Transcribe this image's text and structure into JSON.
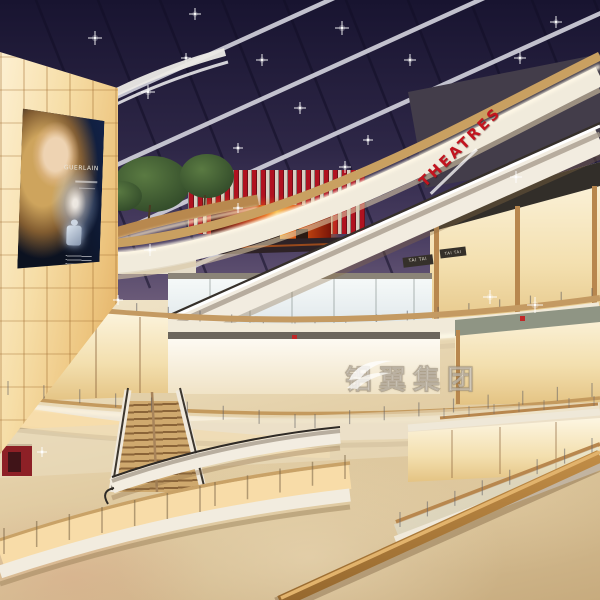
{
  "scene": {
    "description": "Multi-level shopping mall atrium interior at evening, architectural rendering",
    "levels": 5
  },
  "signs": {
    "theatre": "THEATRES",
    "store_tag_1": "TAI TAI",
    "store_tag_2": "TAI TAI",
    "billboard_brand": "GUERLAIN"
  },
  "watermark": {
    "text": "铝翼集团"
  },
  "colors": {
    "sky_top": "#181430",
    "sky_bottom": "#6a5a78",
    "beam": "#d4d4de",
    "theatre_red": "#c3141f",
    "fin_red": "#b5121d",
    "fascia_cream": "#f1ebdc",
    "fascia_wood": "#c9a061",
    "glow_warm": "#f8dca8",
    "floor_light": "#f2e9d4",
    "floor_dark": "#c7ab7e",
    "screen_fire": "#e86a1a",
    "wood_rail": "#b07c3e",
    "wall_glow": "#f6dda6"
  },
  "people": [
    [
      310,
      283,
      11,
      "#d9604a"
    ],
    [
      322,
      282,
      11,
      "#4a6fa8"
    ],
    [
      335,
      284,
      11,
      "#e8e4da"
    ],
    [
      414,
      287,
      11,
      "#8a8a92"
    ],
    [
      472,
      244,
      12,
      "#d8d2c4"
    ],
    [
      487,
      242,
      12,
      "#6a88aa"
    ],
    [
      503,
      244,
      12,
      "#b55248"
    ],
    [
      212,
      245,
      11,
      "#9a9aa2"
    ],
    [
      223,
      246,
      11,
      "#b23a3a"
    ],
    [
      34,
      362,
      14,
      "#c8c4ba"
    ],
    [
      76,
      372,
      13,
      "#5577aa"
    ],
    [
      87,
      373,
      13,
      "#e2ded4"
    ],
    [
      230,
      418,
      13,
      "#c46a78"
    ],
    [
      38,
      452,
      15,
      "#4a78b8"
    ],
    [
      50,
      454,
      15,
      "#88a8cc"
    ],
    [
      62,
      451,
      15,
      "#3a4a6a"
    ],
    [
      110,
      436,
      14,
      "#bb3b32"
    ],
    [
      121,
      438,
      14,
      "#e2702a"
    ],
    [
      131,
      437,
      14,
      "#7788bb"
    ],
    [
      141,
      439,
      14,
      "#ded8cc"
    ],
    [
      152,
      448,
      14,
      "#55887a"
    ],
    [
      16,
      490,
      18,
      "#d8bfc8"
    ],
    [
      30,
      492,
      18,
      "#c8cfe0"
    ],
    [
      470,
      462,
      15,
      "#8a3038"
    ],
    [
      483,
      464,
      15,
      "#c84444"
    ],
    [
      505,
      459,
      15,
      "#33415a"
    ],
    [
      516,
      464,
      15,
      "#e8e6e0"
    ],
    [
      438,
      538,
      17,
      "#e4e6ea",
      "#5a6a8a"
    ],
    [
      543,
      502,
      16,
      "#3a5a78"
    ],
    [
      556,
      505,
      16,
      "#88aabb"
    ],
    [
      568,
      503,
      16,
      "#223a50"
    ],
    [
      580,
      506,
      16,
      "#5577aa"
    ],
    [
      412,
      566,
      15,
      "#8899bb"
    ],
    [
      422,
      568,
      15,
      "#556677"
    ],
    [
      208,
      494,
      16,
      "#35506e"
    ],
    [
      217,
      497,
      16,
      "#7a2a2a"
    ],
    [
      226,
      495,
      16,
      "#d0cdc6"
    ],
    [
      235,
      498,
      16,
      "#3a5a7a"
    ],
    [
      243,
      496,
      16,
      "#8a8a84"
    ],
    [
      150,
      524,
      16,
      "#d8d4ca"
    ],
    [
      161,
      527,
      16,
      "#f2f0ea"
    ],
    [
      183,
      547,
      19,
      "#3a5a44"
    ],
    [
      196,
      549,
      19,
      "#c04040"
    ],
    [
      102,
      552,
      18,
      "#3a4a8a"
    ],
    [
      238,
      542,
      18,
      "#44506a"
    ],
    [
      247,
      545,
      18,
      "#6a7688"
    ],
    [
      268,
      519,
      17,
      "#2e3a50"
    ],
    [
      278,
      522,
      17,
      "#a83a32"
    ],
    [
      288,
      517,
      17,
      "#4a6a88"
    ],
    [
      297,
      521,
      17,
      "#d8c86a"
    ],
    [
      306,
      518,
      17,
      "#24405e"
    ],
    [
      80,
      556,
      20,
      "#d0ccc2"
    ],
    [
      94,
      560,
      20,
      "#fafaf8"
    ]
  ],
  "decor": {
    "clothes_upper": [
      [
        450,
        252,
        3,
        9,
        "#a83a3a"
      ],
      [
        468,
        254,
        3,
        9,
        "#e2ded2"
      ],
      [
        488,
        250,
        3,
        9,
        "#2e3e5e"
      ],
      [
        508,
        252,
        3,
        9,
        "#c8883a"
      ],
      [
        532,
        250,
        3,
        9,
        "#ddd8cc"
      ],
      [
        556,
        252,
        3,
        9,
        "#3a3a3a"
      ],
      [
        578,
        248,
        3,
        9,
        "#a85a4a"
      ],
      [
        262,
        290,
        3,
        8,
        "#888899"
      ],
      [
        278,
        292,
        3,
        8,
        "#aaaabb"
      ],
      [
        300,
        291,
        3,
        8,
        "#cc9999"
      ],
      [
        318,
        290,
        3,
        8,
        "#9999aa"
      ],
      [
        338,
        292,
        3,
        8,
        "#bbaaaa"
      ],
      [
        360,
        290,
        3,
        8,
        "#888899"
      ],
      [
        390,
        291,
        3,
        8,
        "#aa9999"
      ]
    ],
    "clothes_lower": [
      [
        242,
        348,
        4,
        11,
        "#d8b94a"
      ],
      [
        256,
        350,
        4,
        11,
        "#c4452a"
      ],
      [
        274,
        347,
        4,
        11,
        "#333333"
      ],
      [
        290,
        349,
        4,
        11,
        "#e8e2d8"
      ],
      [
        310,
        348,
        4,
        11,
        "#7a3a8a"
      ],
      [
        330,
        349,
        4,
        11,
        "#c87a2a"
      ],
      [
        352,
        348,
        4,
        11,
        "#33557a"
      ],
      [
        372,
        349,
        4,
        11,
        "#dddddd"
      ],
      [
        395,
        348,
        4,
        11,
        "#aa4444"
      ],
      [
        415,
        349,
        4,
        11,
        "#446655"
      ],
      [
        466,
        348,
        4,
        12,
        "#c8c03a"
      ],
      [
        484,
        351,
        4,
        12,
        "#2a2a2a"
      ],
      [
        502,
        348,
        4,
        12,
        "#d8d2c8"
      ],
      [
        520,
        350,
        4,
        12,
        "#804a28"
      ],
      [
        542,
        348,
        4,
        12,
        "#e8d84a"
      ],
      [
        562,
        350,
        4,
        12,
        "#3a3a3a"
      ],
      [
        580,
        348,
        4,
        12,
        "#c84a3a"
      ],
      [
        12,
        342,
        3,
        10,
        "#c3453a"
      ],
      [
        30,
        345,
        3,
        10,
        "#ddd6c8"
      ],
      [
        55,
        343,
        3,
        10,
        "#33506e"
      ],
      [
        120,
        348,
        3,
        10,
        "#88563a"
      ],
      [
        146,
        350,
        3,
        10,
        "#3a3a3a"
      ]
    ],
    "clothes_right": [
      [
        436,
        446,
        3,
        10,
        "#33506e"
      ],
      [
        448,
        448,
        3,
        10,
        "#dddddd"
      ],
      [
        462,
        445,
        3,
        10,
        "#22303e"
      ],
      [
        476,
        447,
        3,
        10,
        "#886655"
      ],
      [
        490,
        445,
        3,
        10,
        "#a84438"
      ],
      [
        506,
        444,
        8,
        7,
        "#e0d6c0"
      ],
      [
        520,
        443,
        8,
        7,
        "#d6cab2"
      ],
      [
        534,
        442,
        8,
        7,
        "#e0d6c0"
      ]
    ],
    "fins": {
      "x1": 380,
      "y1": 160,
      "x2": 515,
      "y2": 85,
      "n": 13,
      "w": 4,
      "h": 24,
      "rot": -21,
      "c": "#b5121d"
    },
    "beams": {
      "x0": -260,
      "dx": 150,
      "n": 6,
      "y0": 268,
      "dx2": 660,
      "dy2": -300,
      "c": "#d4d4de",
      "w": 4.5,
      "o": 0.9
    },
    "mullions": {
      "x0": -30,
      "dx": 62,
      "n": 11,
      "y0": -10,
      "dx2": 118,
      "dy2": 298,
      "c": "rgba(18,14,38,0.55)",
      "w": 2.5,
      "o": 1
    },
    "sky_sparkles": [
      [
        95,
        38,
        7
      ],
      [
        195,
        14,
        6
      ],
      [
        58,
        78,
        6
      ],
      [
        148,
        92,
        7
      ],
      [
        262,
        60,
        6
      ],
      [
        342,
        28,
        7
      ],
      [
        300,
        108,
        6
      ],
      [
        410,
        60,
        6
      ],
      [
        452,
        112,
        6
      ],
      [
        520,
        58,
        6
      ],
      [
        556,
        22,
        6
      ],
      [
        368,
        140,
        5
      ],
      [
        238,
        148,
        5
      ],
      [
        186,
        58,
        5
      ],
      [
        486,
        90,
        5
      ]
    ],
    "front_sparkles": [
      [
        490,
        297,
        7
      ],
      [
        535,
        305,
        8
      ],
      [
        150,
        250,
        6
      ],
      [
        345,
        167,
        6
      ],
      [
        516,
        177,
        6
      ],
      [
        238,
        208,
        5
      ],
      [
        118,
        300,
        5
      ],
      [
        42,
        452,
        5
      ]
    ],
    "posts_b": [
      {
        "x1": 10,
        "y1": 288,
        "x2": 295,
        "y2": 322,
        "n": 10,
        "len": 12,
        "w": 1.2,
        "c": "rgba(80,80,88,0.5)"
      },
      {
        "x1": 315,
        "y1": 322,
        "x2": 592,
        "y2": 288,
        "n": 10,
        "len": 12,
        "w": 1.2,
        "c": "rgba(80,80,88,0.5)"
      }
    ],
    "posts_front": [
      {
        "x1": 8,
        "y1": 381,
        "x2": 295,
        "y2": 414,
        "n": 9,
        "len": 14,
        "w": 1.2,
        "c": "rgba(90,90,95,0.5)"
      },
      {
        "x1": 315,
        "y1": 414,
        "x2": 592,
        "y2": 383,
        "n": 9,
        "len": 14,
        "w": 1.2,
        "c": "rgba(90,90,95,0.5)"
      },
      {
        "x1": 4,
        "y1": 528,
        "x2": 200,
        "y2": 486,
        "n": 7,
        "len": 26,
        "w": 1.5,
        "c": "rgba(120,100,70,0.55)"
      },
      {
        "x1": 215,
        "y1": 482,
        "x2": 345,
        "y2": 455,
        "n": 5,
        "len": 24,
        "w": 1.5,
        "c": "rgba(120,100,70,0.55)"
      },
      {
        "x1": 400,
        "y1": 512,
        "x2": 592,
        "y2": 438,
        "n": 8,
        "len": 15,
        "w": 1.2,
        "c": "rgba(100,100,105,0.55)"
      },
      {
        "x1": 444,
        "y1": 408,
        "x2": 594,
        "y2": 396,
        "n": 7,
        "len": 10,
        "w": 1,
        "c": "rgba(100,100,105,0.5)"
      }
    ]
  }
}
